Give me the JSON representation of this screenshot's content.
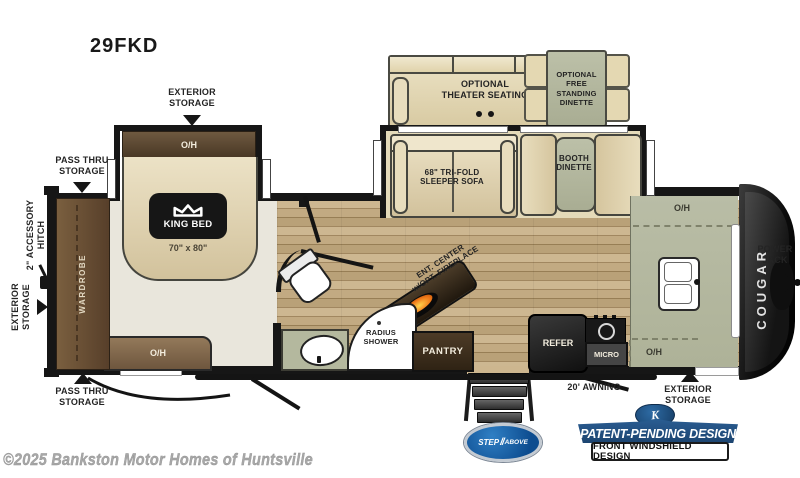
{
  "title": "29FKD",
  "watermark": "©2025 Bankston Motor Homes of Huntsville",
  "callouts": {
    "exterior_storage_top": "EXTERIOR\nSTORAGE",
    "pass_thru_top": "PASS THRU\nSTORAGE",
    "accessory_hitch": "2\" ACCESSORY\nHITCH",
    "exterior_storage_left": "EXTERIOR\nSTORAGE",
    "pass_thru_bottom": "PASS THRU\nSTORAGE",
    "awning": "20' AWNING",
    "exterior_storage_bottom": "EXTERIOR\nSTORAGE",
    "power_jack": "POWER\nJACK"
  },
  "rooms": {
    "wardrobe": "WARDROBE",
    "overhead": "O/H",
    "king_bed": "KING BED",
    "king_bed_size": "70\" x 80\"",
    "theater_seating": "OPTIONAL\nTHEATER SEATING",
    "free_standing_dinette": "OPTIONAL\nFREE\nSTANDING\nDINETTE",
    "sleeper_sofa": "68\" TRI-FOLD\nSLEEPER SOFA",
    "booth_dinette": "BOOTH\nDINETTE",
    "ent_center": "ENT. CENTER\nw/OPT. FIREPLACE",
    "radius_shower": "RADIUS\nSHOWER",
    "pantry": "PANTRY",
    "refer": "REFER",
    "micro": "MICRO"
  },
  "branding": {
    "model_side": "COUGAR",
    "step_logo_left": "STEP",
    "step_logo_separator": "//",
    "step_logo_right": "ABOVE",
    "patent_banner": "PATENT-PENDING DESIGN",
    "windshield_banner": "FRONT WINDSHIELD DESIGN",
    "keystone_k": "K"
  },
  "colors": {
    "wall": "#161616",
    "wood_floor": "#cdb791",
    "bedroom_floor": "#e9e6dc",
    "cabinet_brown": "#5d4732",
    "counter_green": "#b4b89e",
    "upholstery_tan": "#e2d6b4",
    "badge_blue": "#1c4470",
    "flame_orange": "#f07a1a"
  }
}
